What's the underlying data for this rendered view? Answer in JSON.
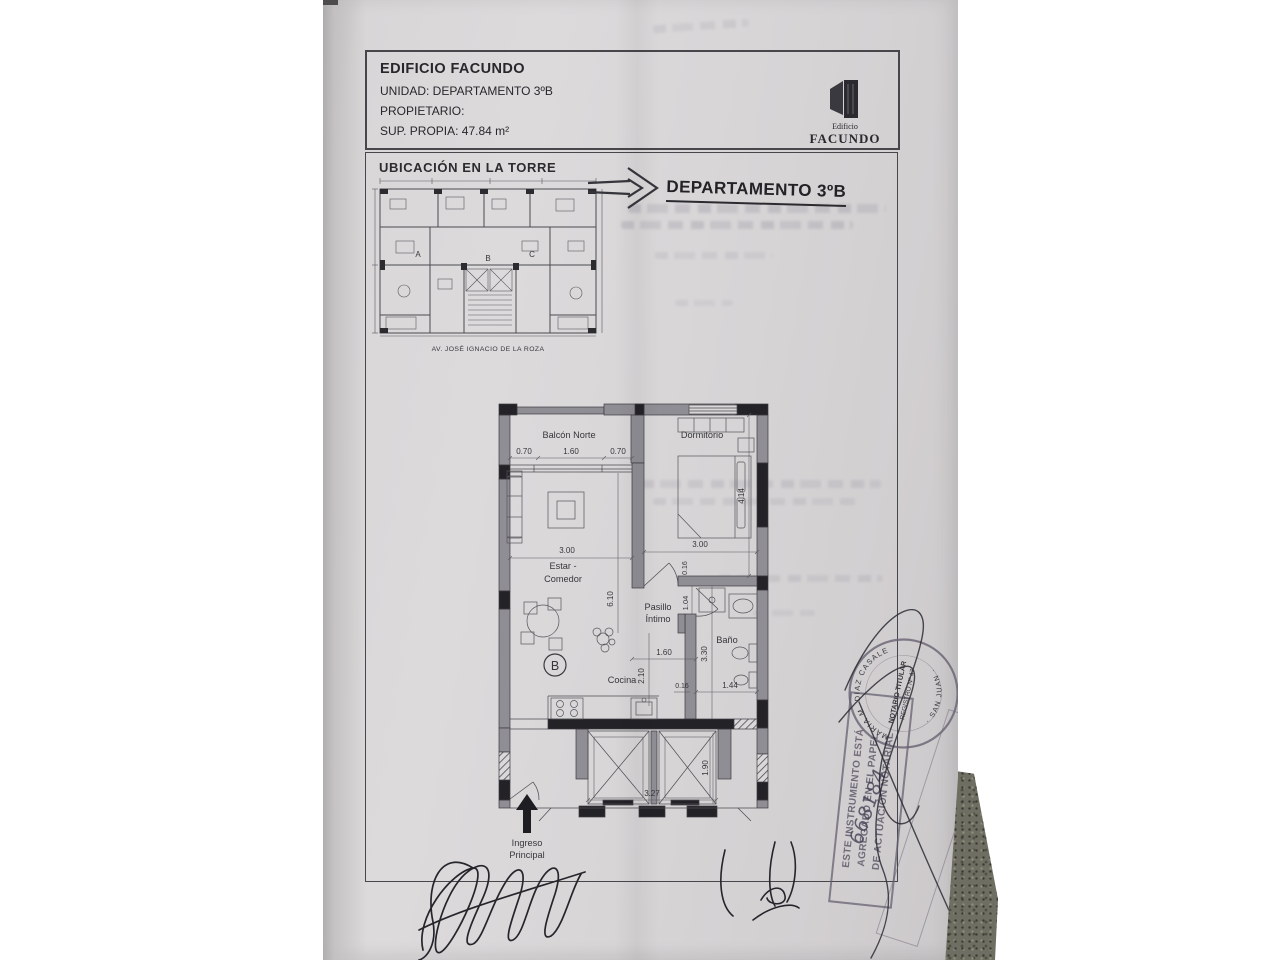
{
  "header": {
    "title": "EDIFICIO FACUNDO",
    "unit": "UNIDAD: DEPARTAMENTO 3ºB",
    "owner": "PROPIETARIO:",
    "area": "SUP. PROPIA: 47.84 m²"
  },
  "logo": {
    "subtitle": "Edificio",
    "name": "FACUNDO"
  },
  "location_plan": {
    "title": "UBICACIÓN EN LA TORRE",
    "street": "AV. JOSÉ IGNACIO DE LA ROZA",
    "unit_a": "A",
    "unit_b": "B",
    "unit_c": "C"
  },
  "plan_title": "DEPARTAMENTO 3ºB",
  "floorplan": {
    "rooms": {
      "balcony": "Balcón Norte",
      "bedroom": "Dormitorio",
      "living_1": "Estar -",
      "living_2": "Comedor",
      "hall_1": "Pasillo",
      "hall_2": "Íntimo",
      "bath": "Baño",
      "kitchen": "Cocina",
      "entry_1": "Ingreso",
      "entry_2": "Principal",
      "unit_letter": "B"
    },
    "dims": {
      "balc_left": "0.70",
      "balc_center": "1.60",
      "balc_right": "0.70",
      "living_w": "3.00",
      "bed_w": "3.00",
      "bed_h": "4.14",
      "wall_top": "0.16",
      "living_h": "6.10",
      "hall_w": "1.04",
      "bath_h": "3.30",
      "kitchen_w": "1.60",
      "kitchen_h": "2.10",
      "wall_small": "0.16",
      "bath_w": "1.44",
      "elev_d": "1.90",
      "elev_w": "3.27"
    }
  },
  "stamps": {
    "round": {
      "name_arc": "MARIA M. DIAZ CASALE",
      "center_1": "NOTARIO TITULAR",
      "center_2": "REGISTRO Nº 47",
      "bottom_arc": "· SAN JUAN ·"
    },
    "rect": {
      "line_1": "ESTE INSTRUMENTO ESTÁ",
      "line_2": "AGREGADO EN EL PAPEL",
      "line_3": "DE ACTUACIÓN NOTARIAL",
      "number": "668184"
    }
  }
}
